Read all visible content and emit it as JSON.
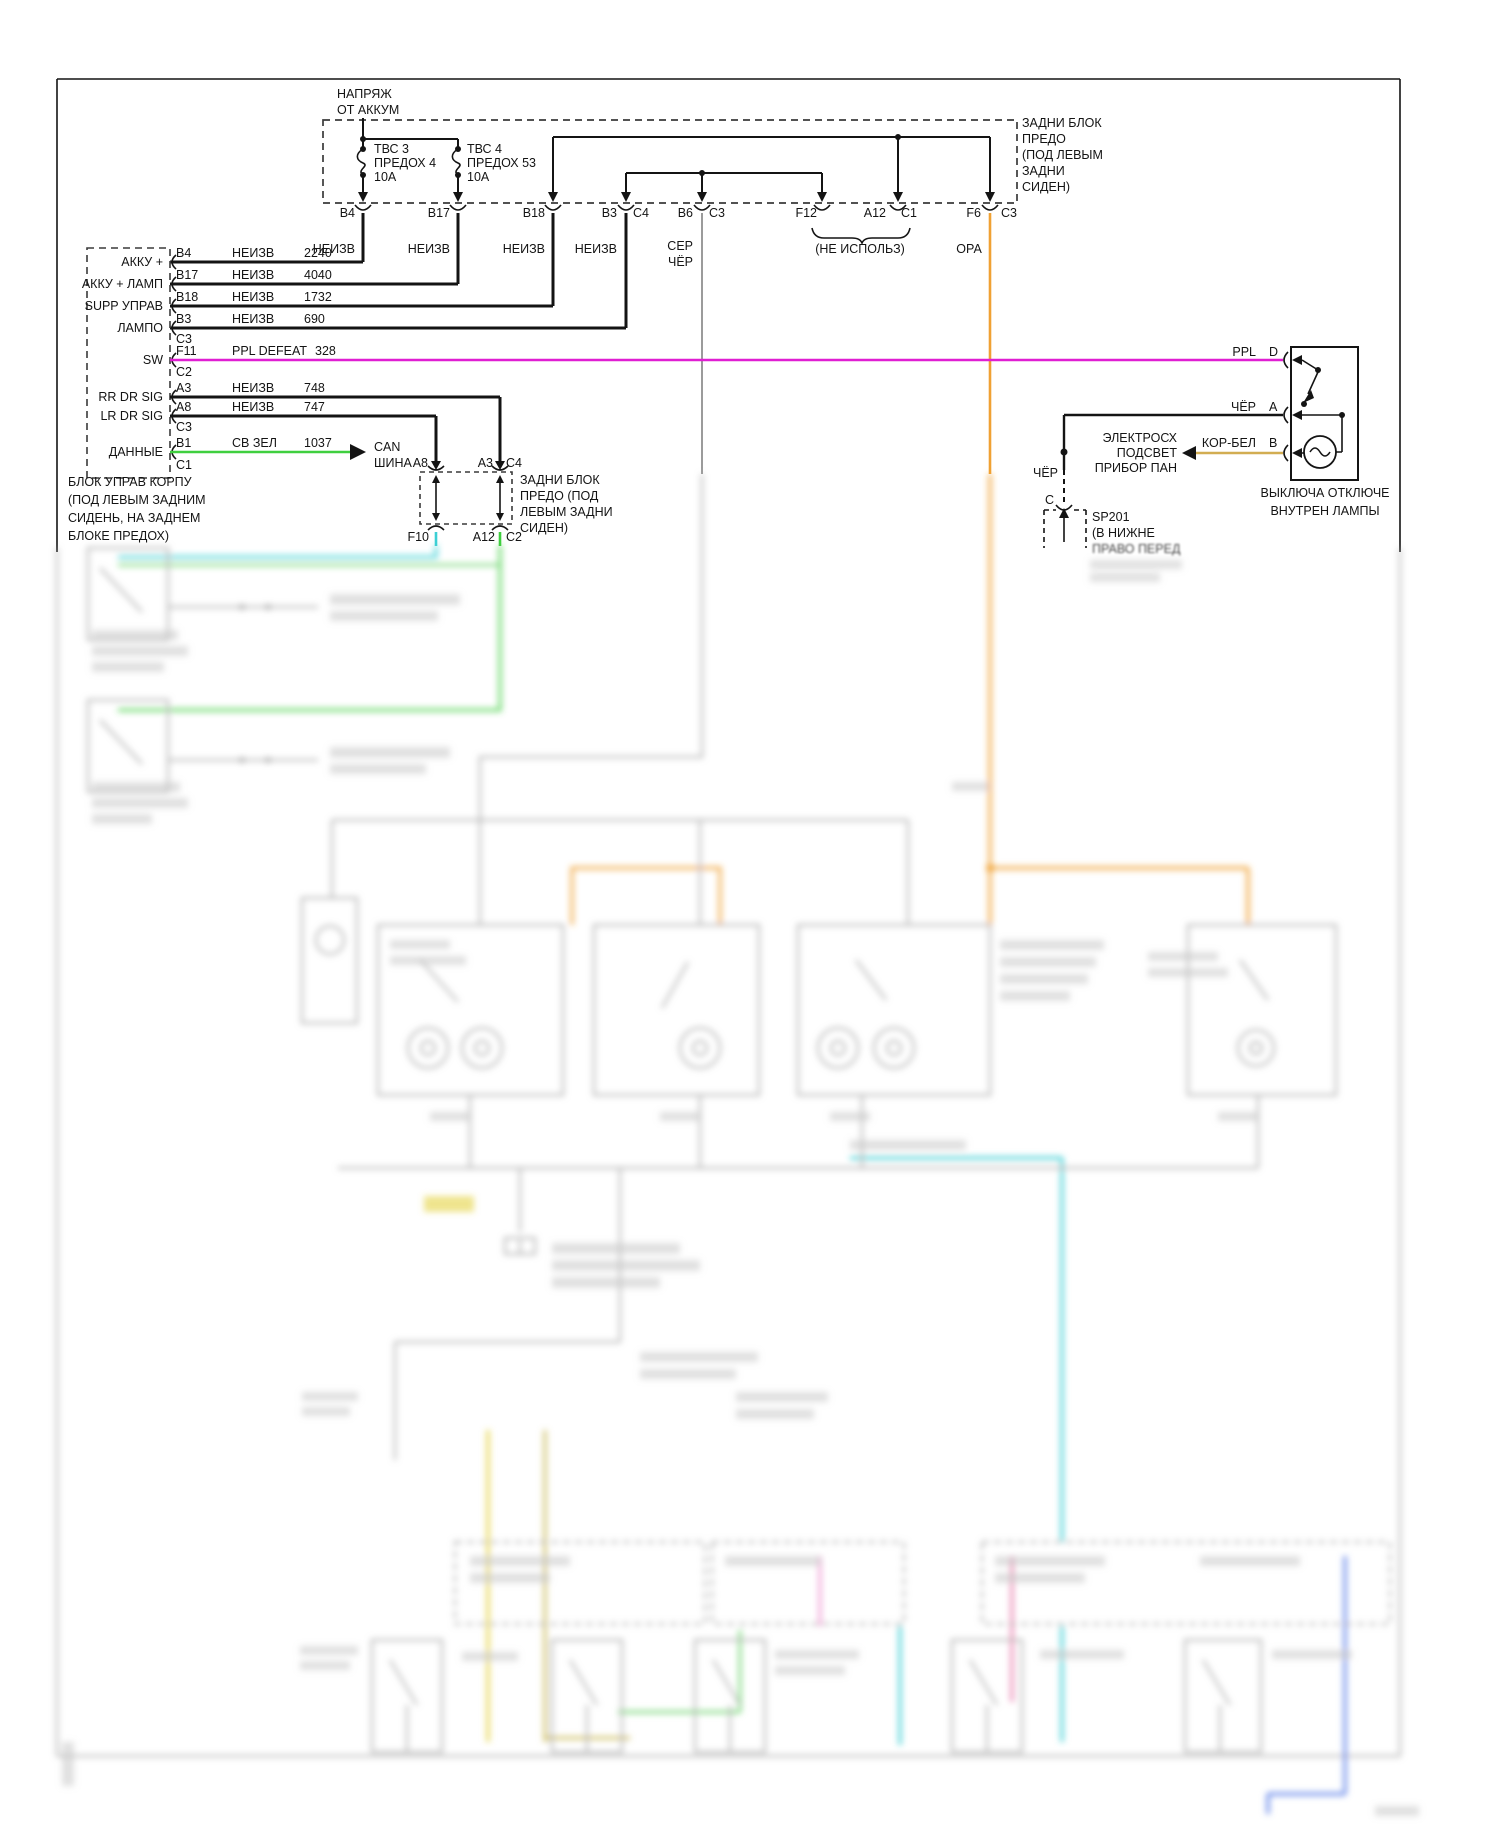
{
  "colors": {
    "magenta": "#e01ed2",
    "orange": "#f0a133",
    "green": "#3fcf3f",
    "cyan": "#3ccfd4",
    "pale_green": "#7ed87e",
    "tan": "#d2ad52",
    "gray": "#9b9b9b",
    "yellow": "#e4d23f",
    "khaki": "#cdbd62",
    "pink": "#ef9ed4",
    "rose": "#e87fae",
    "blue": "#5b80e8"
  },
  "labels": {
    "battery-feed": [
      {
        "n": "battery-feed-line1",
        "t": "НАПРЯЖ",
        "x": 337,
        "y": 98
      },
      {
        "n": "battery-feed-line2",
        "t": "ОТ АККУМ",
        "x": 337,
        "y": 114
      }
    ],
    "fuses": [
      {
        "n": "fuse1-name",
        "t": "ТВС 3",
        "x": 374,
        "y": 153
      },
      {
        "n": "fuse1-id",
        "t": "ПРЕДОХ 4",
        "x": 374,
        "y": 167
      },
      {
        "n": "fuse1-rating",
        "t": "10А",
        "x": 374,
        "y": 181
      },
      {
        "n": "fuse2-name",
        "t": "ТВС 4",
        "x": 467,
        "y": 153
      },
      {
        "n": "fuse2-id",
        "t": "ПРЕДОХ 53",
        "x": 467,
        "y": 167
      },
      {
        "n": "fuse2-rating",
        "t": "10А",
        "x": 467,
        "y": 181
      }
    ],
    "rear-fuse-block-label": [
      {
        "t": "ЗАДНИ БЛОК",
        "x": 1022,
        "y": 127
      },
      {
        "t": "ПРЕДО",
        "x": 1022,
        "y": 143
      },
      {
        "t": "(ПОД ЛЕВЫМ",
        "x": 1022,
        "y": 159
      },
      {
        "t": "ЗАДНИ",
        "x": 1022,
        "y": 175
      },
      {
        "t": "СИДЕН)",
        "x": 1022,
        "y": 191
      }
    ],
    "fuse-block-pins": [
      {
        "t": "B4",
        "x": 355,
        "y": 217,
        "a": "end"
      },
      {
        "t": "B17",
        "x": 450,
        "y": 217,
        "a": "end"
      },
      {
        "t": "B18",
        "x": 545,
        "y": 217,
        "a": "end"
      },
      {
        "t": "B3",
        "x": 617,
        "y": 217,
        "a": "end"
      },
      {
        "t": "C4",
        "x": 633,
        "y": 217
      },
      {
        "t": "B6",
        "x": 693,
        "y": 217,
        "a": "end"
      },
      {
        "t": "C3",
        "x": 709,
        "y": 217
      },
      {
        "t": "F12",
        "x": 817,
        "y": 217,
        "a": "end"
      },
      {
        "t": "A12",
        "x": 886,
        "y": 217,
        "a": "end"
      },
      {
        "t": "C1",
        "x": 901,
        "y": 217
      },
      {
        "t": "F6",
        "x": 981,
        "y": 217,
        "a": "end"
      },
      {
        "t": "C3",
        "x": 1001,
        "y": 217
      }
    ],
    "fuse-block-wire-colors": [
      {
        "t": "НЕИЗВ",
        "x": 355,
        "y": 253,
        "a": "end"
      },
      {
        "t": "НЕИЗВ",
        "x": 450,
        "y": 253,
        "a": "end"
      },
      {
        "t": "НЕИЗВ",
        "x": 545,
        "y": 253,
        "a": "end"
      },
      {
        "t": "НЕИЗВ",
        "x": 617,
        "y": 253,
        "a": "end"
      },
      {
        "t": "СЕР",
        "x": 693,
        "y": 250,
        "a": "end"
      },
      {
        "t": "ЧЁР",
        "x": 693,
        "y": 266,
        "a": "end"
      },
      {
        "t": "(НЕ ИСПОЛЬЗ)",
        "x": 860,
        "y": 253,
        "a": "middle"
      },
      {
        "t": "ОРА",
        "x": 969,
        "y": 253,
        "a": "middle"
      }
    ],
    "bcm-signals": [
      {
        "t": "АККУ +",
        "x": 163,
        "y": 266,
        "a": "end"
      },
      {
        "t": "АККУ + ЛАМП",
        "x": 163,
        "y": 288,
        "a": "end"
      },
      {
        "t": "SUPP УПРАВ",
        "x": 163,
        "y": 310,
        "a": "end"
      },
      {
        "t": "ЛАМПО",
        "x": 163,
        "y": 332,
        "a": "end"
      },
      {
        "t": "SW",
        "x": 163,
        "y": 364,
        "a": "end"
      },
      {
        "t": "RR DR SIG",
        "x": 163,
        "y": 401,
        "a": "end"
      },
      {
        "t": "LR DR SIG",
        "x": 163,
        "y": 420,
        "a": "end"
      },
      {
        "t": "ДАННЫЕ",
        "x": 163,
        "y": 456,
        "a": "end"
      }
    ],
    "bcm-rows": [
      {
        "t": "B4",
        "x": 176,
        "y": 257
      },
      {
        "t": "НЕИЗВ",
        "x": 232,
        "y": 257
      },
      {
        "t": "2240",
        "x": 304,
        "y": 257
      },
      {
        "t": "B17",
        "x": 176,
        "y": 279
      },
      {
        "t": "НЕИЗВ",
        "x": 232,
        "y": 279
      },
      {
        "t": "4040",
        "x": 304,
        "y": 279
      },
      {
        "t": "B18",
        "x": 176,
        "y": 301
      },
      {
        "t": "НЕИЗВ",
        "x": 232,
        "y": 301
      },
      {
        "t": "1732",
        "x": 304,
        "y": 301
      },
      {
        "t": "B3",
        "x": 176,
        "y": 323
      },
      {
        "t": "НЕИЗВ",
        "x": 232,
        "y": 323
      },
      {
        "t": "690",
        "x": 304,
        "y": 323
      },
      {
        "t": "C3",
        "x": 176,
        "y": 343
      },
      {
        "t": "F11",
        "x": 176,
        "y": 355
      },
      {
        "t": "PPL DEFEAT",
        "x": 232,
        "y": 355
      },
      {
        "t": "328",
        "x": 315,
        "y": 355
      },
      {
        "t": "C2",
        "x": 176,
        "y": 376
      },
      {
        "t": "A3",
        "x": 176,
        "y": 392
      },
      {
        "t": "НЕИЗВ",
        "x": 232,
        "y": 392
      },
      {
        "t": "748",
        "x": 304,
        "y": 392
      },
      {
        "t": "A8",
        "x": 176,
        "y": 411
      },
      {
        "t": "НЕИЗВ",
        "x": 232,
        "y": 411
      },
      {
        "t": "747",
        "x": 304,
        "y": 411
      },
      {
        "t": "C3",
        "x": 176,
        "y": 431
      },
      {
        "t": "B1",
        "x": 176,
        "y": 447
      },
      {
        "t": "СВ ЗЕЛ",
        "x": 232,
        "y": 447
      },
      {
        "t": "1037",
        "x": 304,
        "y": 447
      },
      {
        "t": "C1",
        "x": 176,
        "y": 469
      }
    ],
    "can-bus": [
      {
        "t": "CAN",
        "x": 374,
        "y": 451
      },
      {
        "t": "ШИНА",
        "x": 374,
        "y": 467
      }
    ],
    "bcm-caption": [
      {
        "t": "БЛОК УПРАВ КОРПУ",
        "x": 68,
        "y": 486
      },
      {
        "t": "(ПОД ЛЕВЫМ ЗАДНИМ",
        "x": 68,
        "y": 504
      },
      {
        "t": "СИДЕНЬ, НА ЗАДНЕМ",
        "x": 68,
        "y": 522
      },
      {
        "t": "БЛОКЕ ПРЕДОХ)",
        "x": 68,
        "y": 540
      }
    ],
    "mid-connector-pins": [
      {
        "t": "A8",
        "x": 428,
        "y": 467,
        "a": "end"
      },
      {
        "t": "A3",
        "x": 493,
        "y": 467,
        "a": "end"
      },
      {
        "t": "C4",
        "x": 506,
        "y": 467
      },
      {
        "t": "F10",
        "x": 429,
        "y": 541,
        "a": "end"
      },
      {
        "t": "A12",
        "x": 495,
        "y": 541,
        "a": "end"
      },
      {
        "t": "C2",
        "x": 506,
        "y": 541
      }
    ],
    "mid-connector-label": [
      {
        "t": "ЗАДНИ БЛОК",
        "x": 520,
        "y": 484
      },
      {
        "t": "ПРЕДО (ПОД",
        "x": 520,
        "y": 500
      },
      {
        "t": "ЛЕВЫМ ЗАДНИ",
        "x": 520,
        "y": 516
      },
      {
        "t": "СИДЕН)",
        "x": 520,
        "y": 532
      }
    ],
    "switch-pins": [
      {
        "t": "PPL",
        "x": 1256,
        "y": 356,
        "a": "end"
      },
      {
        "t": "D",
        "x": 1269,
        "y": 356
      },
      {
        "t": "ЧЁР",
        "x": 1256,
        "y": 411,
        "a": "end"
      },
      {
        "t": "A",
        "x": 1269,
        "y": 411
      },
      {
        "t": "КОР-БЕЛ",
        "x": 1256,
        "y": 447,
        "a": "end"
      },
      {
        "t": "B",
        "x": 1269,
        "y": 447
      }
    ],
    "panel-lamps-arrow": [
      {
        "t": "ЭЛЕКТРОСХ",
        "x": 1177,
        "y": 442,
        "a": "end"
      },
      {
        "t": "ПОДСВЕТ",
        "x": 1177,
        "y": 457,
        "a": "end"
      },
      {
        "t": "ПРИБОР ПАН",
        "x": 1177,
        "y": 472,
        "a": "end"
      }
    ],
    "switch-caption": [
      {
        "t": "ВЫКЛЮЧА ОТКЛЮЧЕ",
        "x": 1325,
        "y": 497,
        "a": "middle"
      },
      {
        "t": "ВНУТРЕН ЛАМПЫ",
        "x": 1325,
        "y": 515,
        "a": "middle"
      }
    ],
    "ground-sp201": [
      {
        "t": "ЧЁР",
        "x": 1058,
        "y": 477,
        "a": "end"
      },
      {
        "t": "C",
        "x": 1054,
        "y": 504,
        "a": "end"
      },
      {
        "t": "SP201",
        "x": 1092,
        "y": 521
      },
      {
        "t": "(В НИЖНЕ",
        "x": 1092,
        "y": 537
      },
      {
        "t": "ПРАВО ПЕРЕД",
        "x": 1092,
        "y": 553,
        "f": 1
      }
    ]
  }
}
